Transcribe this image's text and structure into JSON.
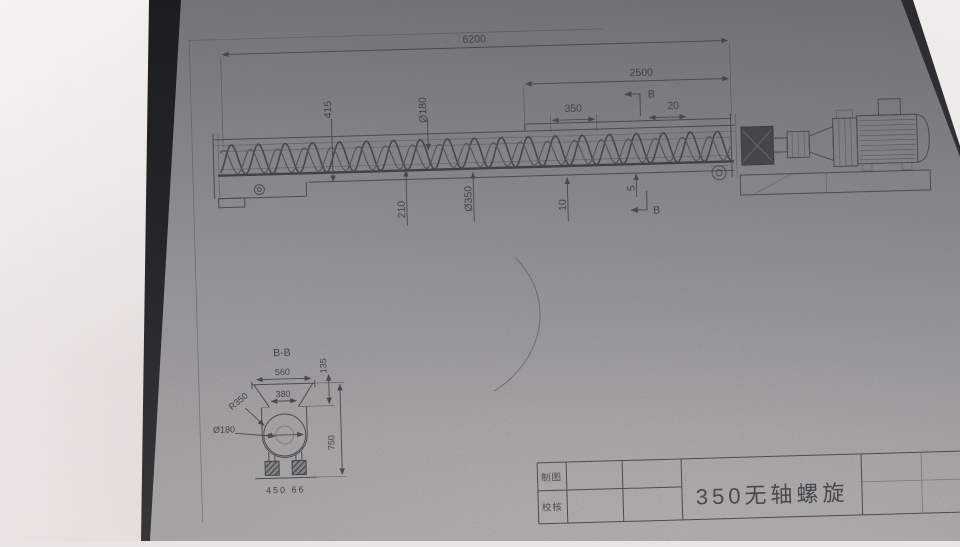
{
  "drawing": {
    "main_view": {
      "dims": {
        "overall_length": "6200",
        "drive_section_length": "2500",
        "outlet_length": "350",
        "gap": "20",
        "inlet_height": "415",
        "core_diameter": "Ø180",
        "outlet_drop": "210",
        "spiral_diameter": "Ø350",
        "clearance_10": "10",
        "clearance_5": "5",
        "section_letter_top": "B",
        "section_letter_bottom": "B"
      }
    },
    "section_view": {
      "title": "B-B",
      "dims": {
        "top_width": "560",
        "inner_width": "380",
        "flange_height": "135",
        "trough_radius": "R350",
        "core_diameter": "Ø180",
        "total_height": "750",
        "base_note": "450 66"
      }
    },
    "title_block": {
      "row1_label": "制图",
      "row2_label": "校核",
      "title": "350无轴螺旋"
    }
  }
}
